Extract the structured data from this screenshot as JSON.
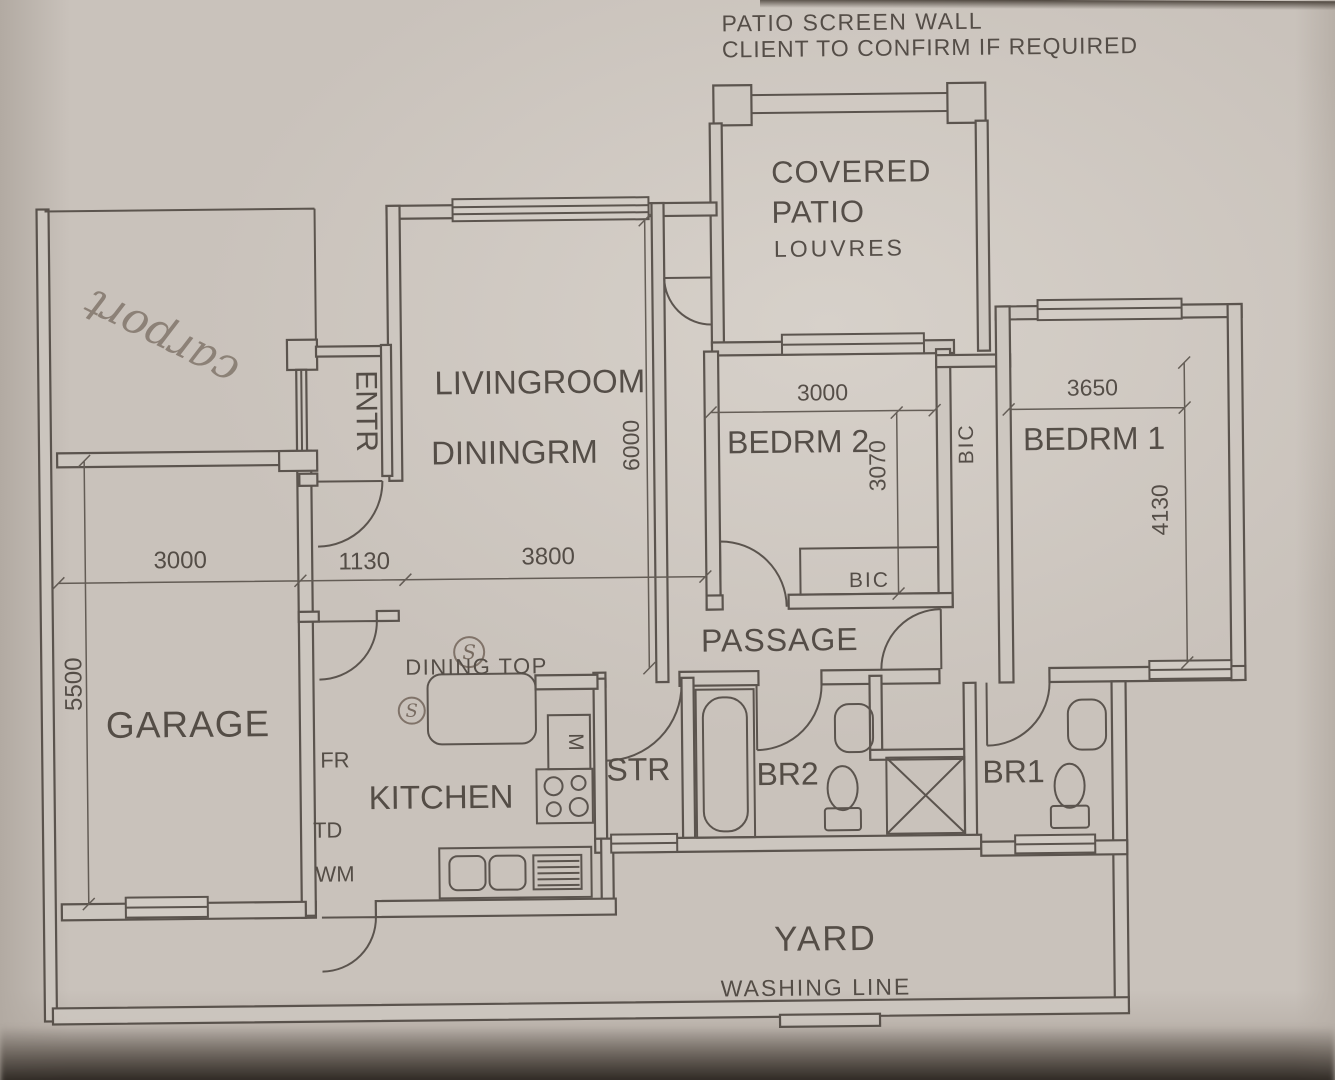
{
  "annotations": {
    "note_line1": "PATIO SCREEN WALL",
    "note_line2": "CLIENT TO CONFIRM IF REQUIRED",
    "carport": "carport",
    "s1": "S",
    "s2": "S"
  },
  "rooms": {
    "patio1": "COVERED",
    "patio2": "PATIO",
    "patio_sub": "LOUVRES",
    "living": "LIVINGROOM",
    "dining": "DININGRM",
    "entrance": "ENTR",
    "garage": "GARAGE",
    "kitchen": "KITCHEN",
    "dining_top": "DINING TOP",
    "store": "STR",
    "bath2": "BR2",
    "bath1": "BR1",
    "passage": "PASSAGE",
    "bedroom2": "BEDRM 2",
    "bedroom1": "BEDRM 1",
    "bic_passage": "BIC",
    "bic_bedroom2": "BIC",
    "yard": "YARD",
    "washing_line": "WASHING LINE"
  },
  "appliances": {
    "fridge": "FR",
    "tumble_dryer": "TD",
    "washing_machine": "WM",
    "microwave": "M"
  },
  "dimensions": {
    "garage_width": "3000",
    "garage_length": "5500",
    "entrance_width": "1130",
    "living_width": "3800",
    "living_length": "6000",
    "bedroom2_width": "3000",
    "bedroom2_length": "3070",
    "bedroom1_width": "3650",
    "bedroom1_length": "4130"
  },
  "colors": {
    "paper": "#c9c2bb",
    "ink": "#4c453f",
    "pencil": "#6d6055"
  }
}
